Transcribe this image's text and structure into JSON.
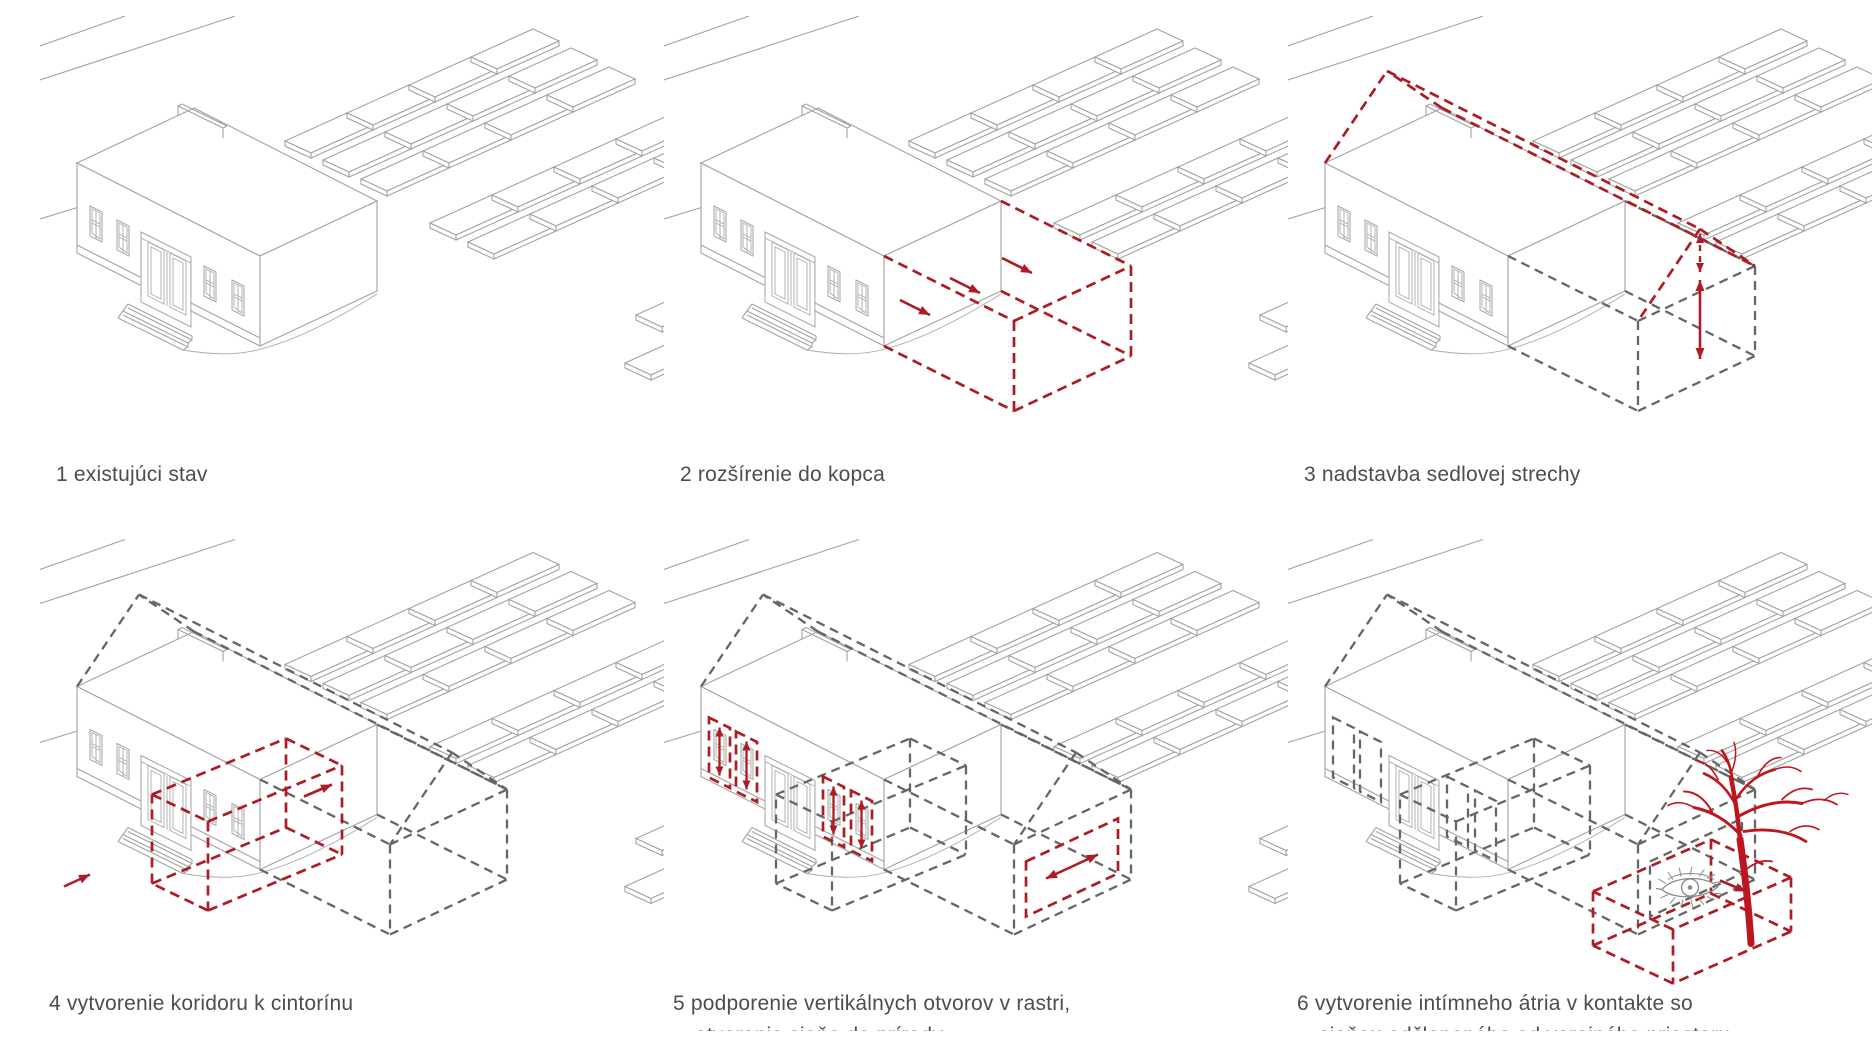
{
  "diagram": {
    "title": "transformation concept axonometric series",
    "language": "sk",
    "panels": [
      {
        "id": "1",
        "caption_lines": [
          "1 existujúci stav"
        ],
        "layers": [
          "roads",
          "graves",
          "building"
        ]
      },
      {
        "id": "2",
        "caption_lines": [
          "2 rozšírenie do kopca"
        ],
        "layers": [
          "roads",
          "graves",
          "building",
          "extension-red",
          "extension-arrows"
        ]
      },
      {
        "id": "3",
        "caption_lines": [
          "3 nadstavba sedlovej strechy"
        ],
        "layers": [
          "roads",
          "graves",
          "building",
          "extension-gray",
          "gable-red",
          "height-arrows"
        ]
      },
      {
        "id": "4",
        "caption_lines": [
          "4 vytvorenie koridoru k cintorínu"
        ],
        "layers": [
          "roads",
          "graves",
          "building",
          "extension-gray",
          "gable-gray",
          "corridor-red",
          "corridor-arrows"
        ]
      },
      {
        "id": "5",
        "caption_lines": [
          "5 podporenie vertikálnych otvorov v rastri,",
          "otvorenie sieňe do prírody"
        ],
        "layers": [
          "roads",
          "graves",
          "building",
          "extension-gray",
          "gable-gray",
          "corridor-gray",
          "window-frames-red",
          "window-arrows",
          "wall-opening-red",
          "opening-arrow"
        ]
      },
      {
        "id": "6",
        "caption_lines": [
          "6 vytvorenie intímneho átria v kontakte so",
          "sieňou odčleneného od verejného priestoru"
        ],
        "layers": [
          "roads",
          "graves",
          "building-no-windows",
          "extension-gray",
          "gable-gray",
          "corridor-gray",
          "window-frames-gray",
          "wall-opening-gray",
          "atrium-red",
          "tree",
          "eye",
          "eye-arrow"
        ]
      }
    ]
  },
  "icons": {
    "tree": "tree-icon",
    "eye": "eye-icon",
    "direction_arrow": "direction-arrow-icon",
    "measure_arrow": "double-arrow-icon"
  },
  "colors": {
    "background": "#ffffff",
    "accent_red": "#AD1C24",
    "tree_red": "#BE161E",
    "line_gray": "#A3A3A3",
    "detail_gray": "#ABABAB",
    "dash_gray": "#666666",
    "eye_gray": "#8A8A8A",
    "text_gray": "#4D4D4D"
  }
}
